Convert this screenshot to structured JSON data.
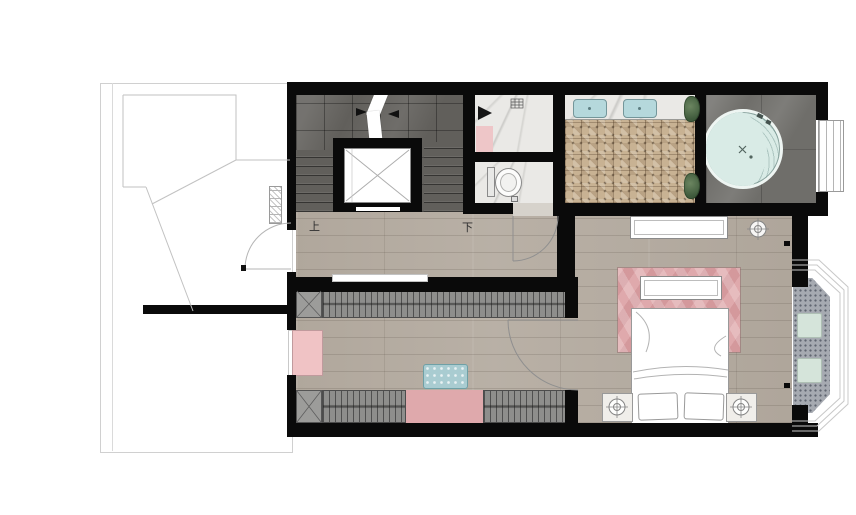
{
  "floorplan": {
    "labels": {
      "stairs_up": "上",
      "stairs_down": "下"
    },
    "colors": {
      "wall": "#0a0a0a",
      "wood_floor": "#b5aca1",
      "stone_stair": "#615f5b",
      "stone_jacuzzi": "#6f6e6a",
      "marble": "#eae9e6",
      "mosaic_tan": "#c8b293",
      "sink_blue": "#b5d8dc",
      "jacuzzi_water": "#d9ebe6",
      "tub_rim": "#eef5f2",
      "rug_pink": "#dfa9ac",
      "mat_pink": "#eec6c8",
      "dresser_pink": "#f0c3c5",
      "wardrobe_gray": "#8e8e8c",
      "ottoman_blue": "#a9ccd1",
      "balcony_gray": "#a6aab1",
      "cushion_green": "#d5e4da",
      "plant_green": "#4f6b48"
    },
    "icons": {
      "ceiling_light": "circle-crosshair",
      "stair_direction_arrow": "white-diagonal-arrow",
      "shower_head": "black-triangle",
      "elevator": "box-with-x"
    }
  }
}
